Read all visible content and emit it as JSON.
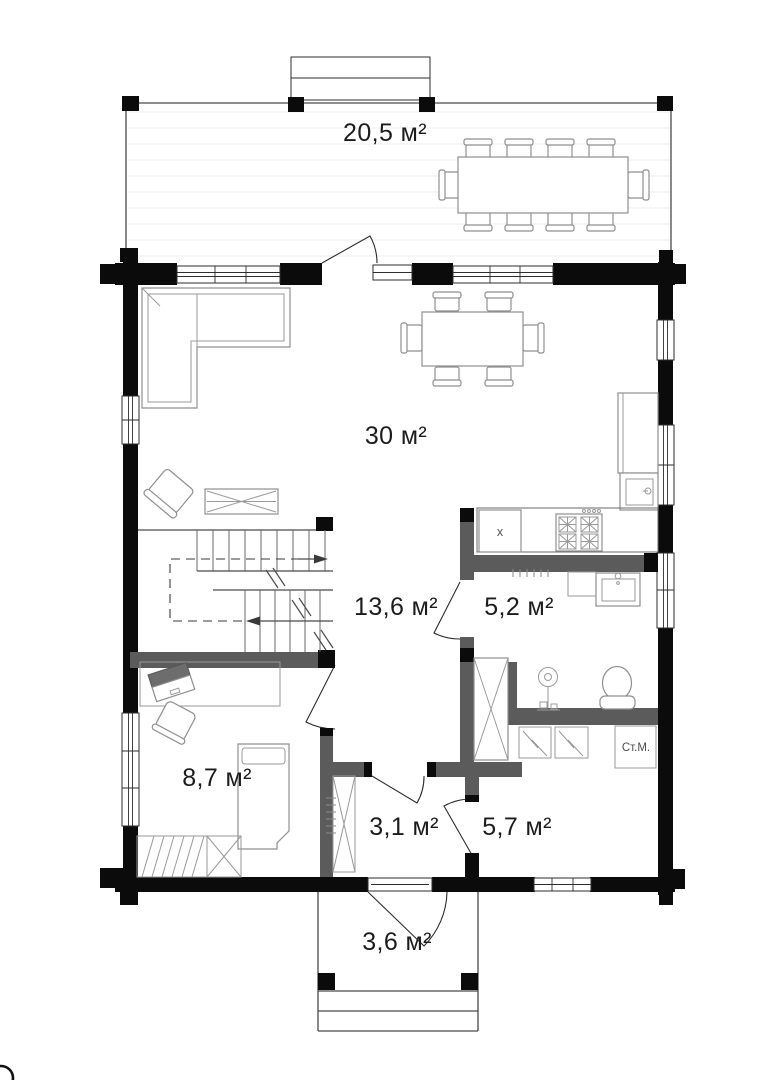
{
  "document": {
    "type": "floor-plan",
    "floor": "first"
  },
  "rooms": [
    {
      "id": "terrace",
      "label": "20,5 м²"
    },
    {
      "id": "living-room",
      "label": "30 м²"
    },
    {
      "id": "hallway",
      "label": "13,6 м²"
    },
    {
      "id": "bathroom",
      "label": "5,2 м²"
    },
    {
      "id": "bedroom",
      "label": "8,7 м²"
    },
    {
      "id": "entry-hall",
      "label": "3,1 м²"
    },
    {
      "id": "utility",
      "label": "5,7 м²"
    },
    {
      "id": "porch",
      "label": "3,6 м²"
    }
  ],
  "appliances": {
    "washing_machine": "Ст.М.",
    "kitchen_unit": "x"
  },
  "colors": {
    "exterior_wall": "#0b0b0b",
    "interior_wall": "#5b5b5b",
    "furniture_line": "#8f8f8f",
    "label_text": "#1c1c1c",
    "floor": "#ffffff"
  }
}
